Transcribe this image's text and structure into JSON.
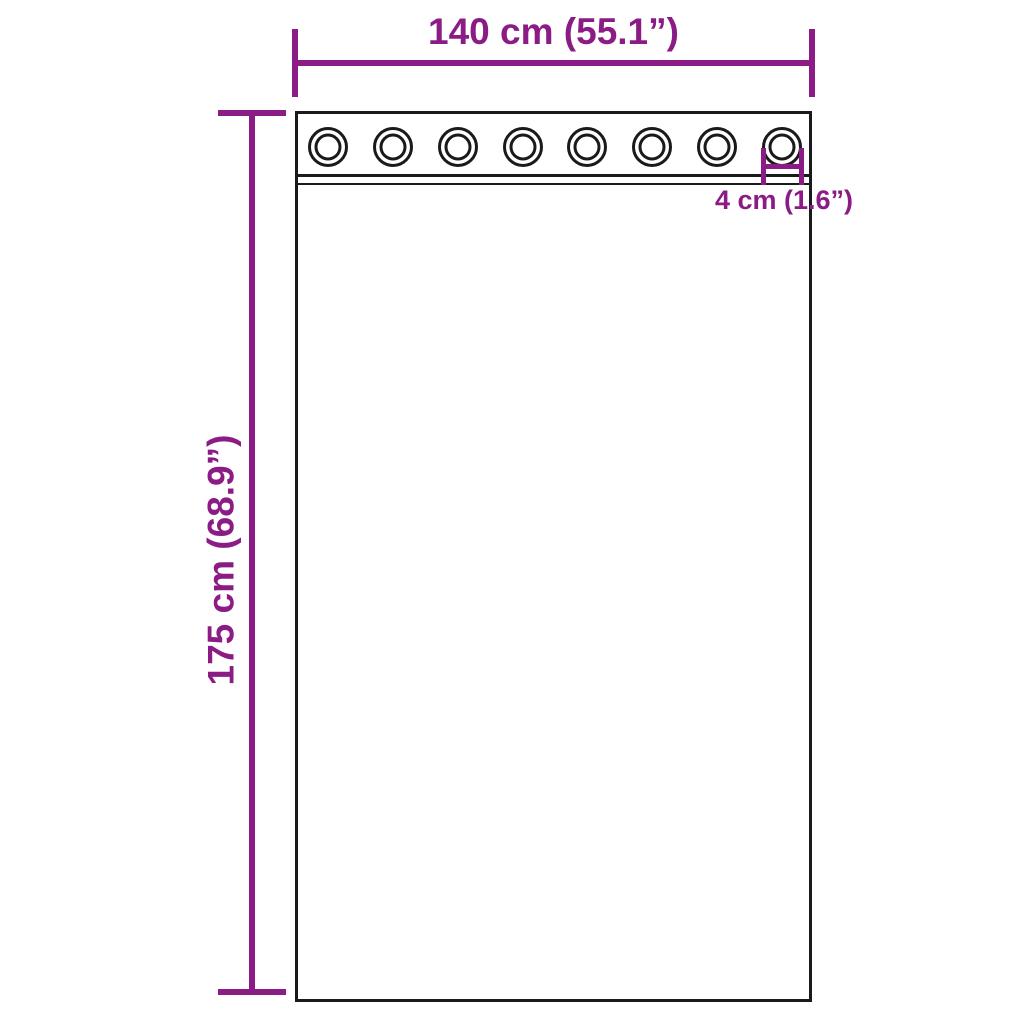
{
  "diagram": {
    "width_label": "140 cm (55.1”)",
    "height_label": "175 cm (68.9”)",
    "grommet_diameter_label": "4 cm (1.6”)",
    "grommet_count": 8,
    "colors": {
      "dimension_accent": "#8c1c85",
      "outline": "#1a1a1a",
      "background": "#ffffff"
    }
  }
}
